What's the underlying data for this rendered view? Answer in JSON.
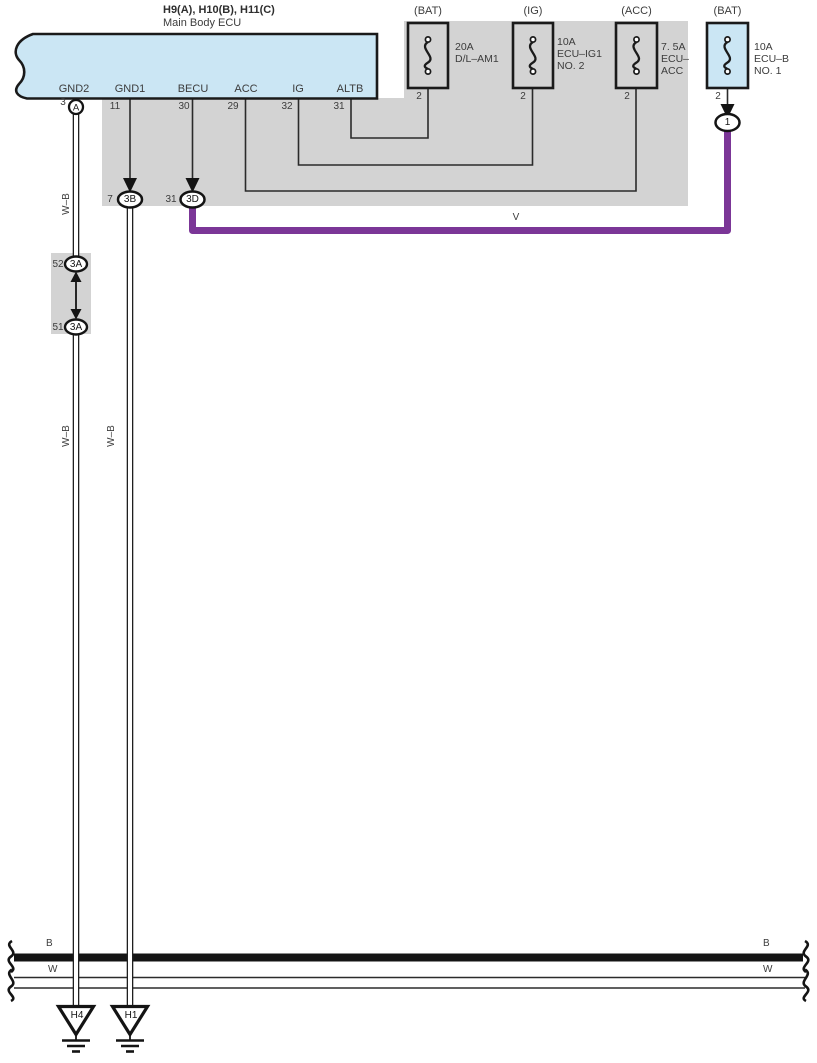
{
  "ecu": {
    "code": "H9(A), H10(B), H11(C)",
    "name": "Main Body ECU",
    "pins": [
      {
        "label": "GND2",
        "pin": "3"
      },
      {
        "label": "GND1",
        "pin": "11"
      },
      {
        "label": "BECU",
        "pin": "30"
      },
      {
        "label": "ACC",
        "pin": "29"
      },
      {
        "label": "IG",
        "pin": "32"
      },
      {
        "label": "ALTB",
        "pin": "31"
      }
    ]
  },
  "fuses": [
    {
      "source": "(BAT)",
      "rating": "20A",
      "line2": "D/L–AM1",
      "line3": "",
      "pin": "2"
    },
    {
      "source": "(IG)",
      "rating": "10A",
      "line2": "ECU–IG1",
      "line3": "NO. 2",
      "pin": "2"
    },
    {
      "source": "(ACC)",
      "rating": "7. 5A",
      "line2": "ECU–",
      "line3": "ACC",
      "pin": "2"
    },
    {
      "source": "(BAT)",
      "rating": "10A",
      "line2": "ECU–B",
      "line3": "NO. 1",
      "pin": "2"
    }
  ],
  "connectors": {
    "a": {
      "pin": "3",
      "label": "A"
    },
    "b3b": {
      "pin": "7",
      "label": "3B"
    },
    "b3d": {
      "pin": "31",
      "label": "3D"
    },
    "j52": {
      "pin": "52",
      "label": "3A"
    },
    "j51": {
      "pin": "51",
      "label": "3A"
    },
    "e1": {
      "label": "1"
    }
  },
  "wire_labels": {
    "wb": "W–B",
    "violet": "V",
    "bus_black": "B",
    "bus_white": "W"
  },
  "grounds": [
    {
      "label": "H4"
    },
    {
      "label": "H1"
    }
  ],
  "colors": {
    "ecu_fill": "#cbe6f4",
    "region_fill": "#d3d3d3",
    "violet_wire": "#7b3697",
    "line": "#1a1a1a"
  }
}
